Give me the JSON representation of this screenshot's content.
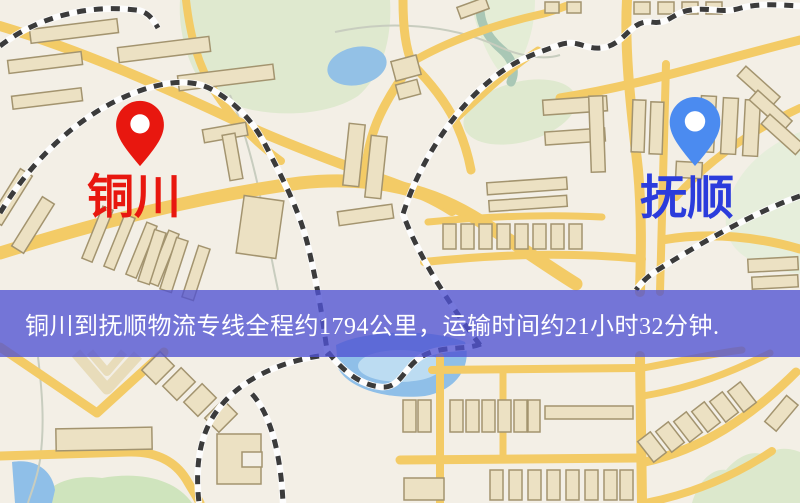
{
  "markers": {
    "origin": {
      "name": "铜川",
      "pin_color": "#e8170f",
      "label_color": "#e8170f"
    },
    "destination": {
      "name": "抚顺",
      "pin_color": "#4b8bf0",
      "label_color": "#2b3cdc"
    }
  },
  "banner": {
    "text": "铜川到抚顺物流专线全程约1794公里，运输时间约21小时32分钟.",
    "background_color": "rgba(79,82,210,0.78)",
    "text_color": "#ffffff"
  },
  "route": {
    "origin": "铜川",
    "destination": "抚顺",
    "distance_km": 1794,
    "duration": "21小时32分钟"
  },
  "map_palette": {
    "background": "#f3efe6",
    "road": "#f3cb66",
    "railway_dash": "#3b3b3b",
    "railway_base": "#fdfdfd",
    "park": "#dfe9cf",
    "water": "#8fbfe8",
    "building_fill": "#ece1c3",
    "building_outline": "#a3946f"
  }
}
